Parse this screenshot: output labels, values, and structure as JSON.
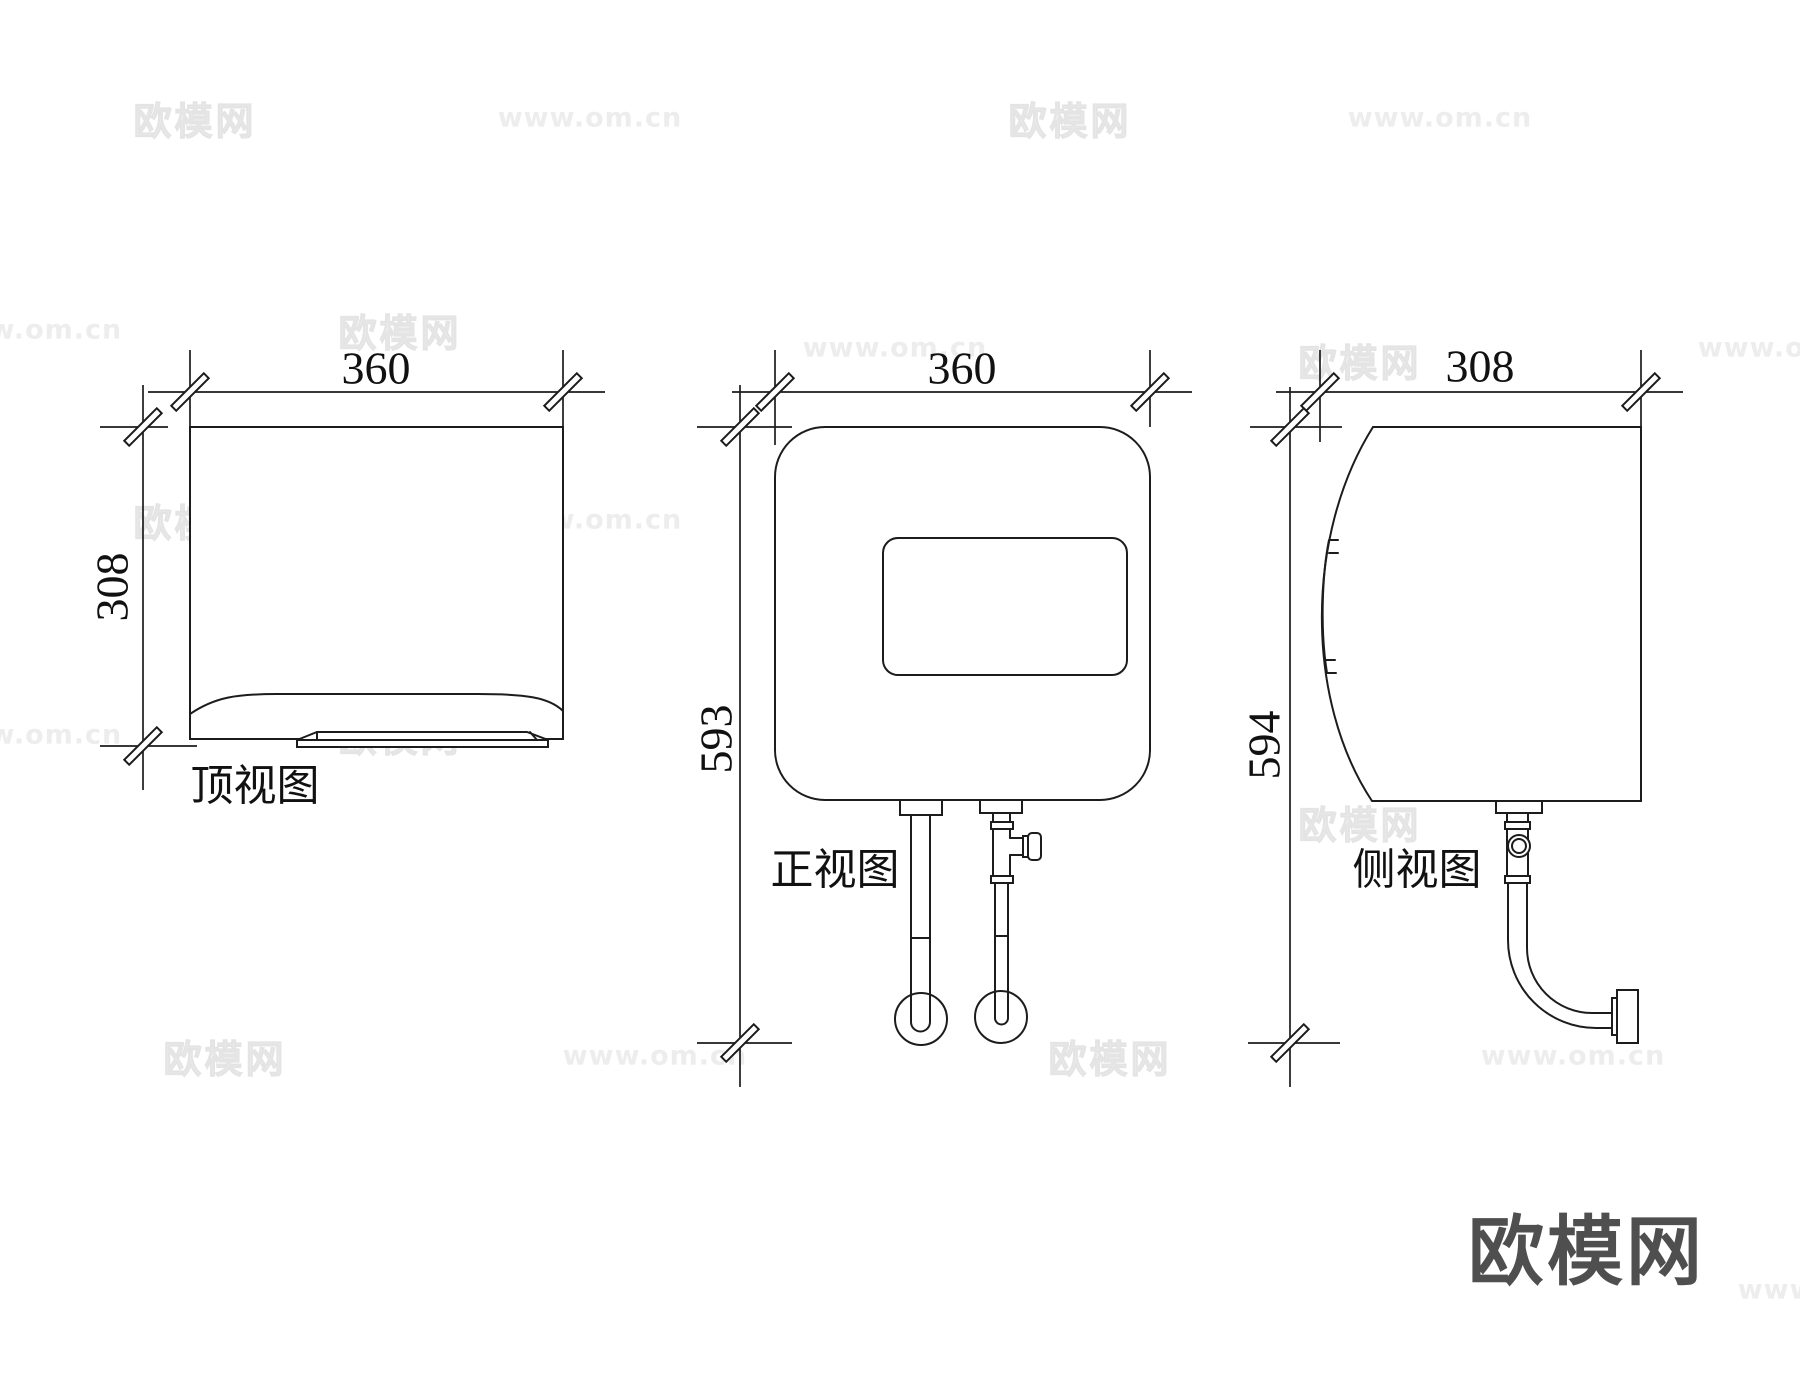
{
  "page": {
    "background": "#ffffff",
    "line_color": "#1c1c1c"
  },
  "watermark": {
    "brand": "欧模网",
    "url": "www.om.cn",
    "color": "#ededed"
  },
  "logo": {
    "text": "欧模网",
    "color": "#4f4f4f"
  },
  "views": {
    "top": {
      "label": "顶视图",
      "width_dim": "360",
      "depth_dim": "308"
    },
    "front": {
      "label": "正视图",
      "width_dim": "360",
      "height_dim": "593"
    },
    "side": {
      "label": "侧视图",
      "depth_dim": "308",
      "height_dim": "594"
    }
  }
}
